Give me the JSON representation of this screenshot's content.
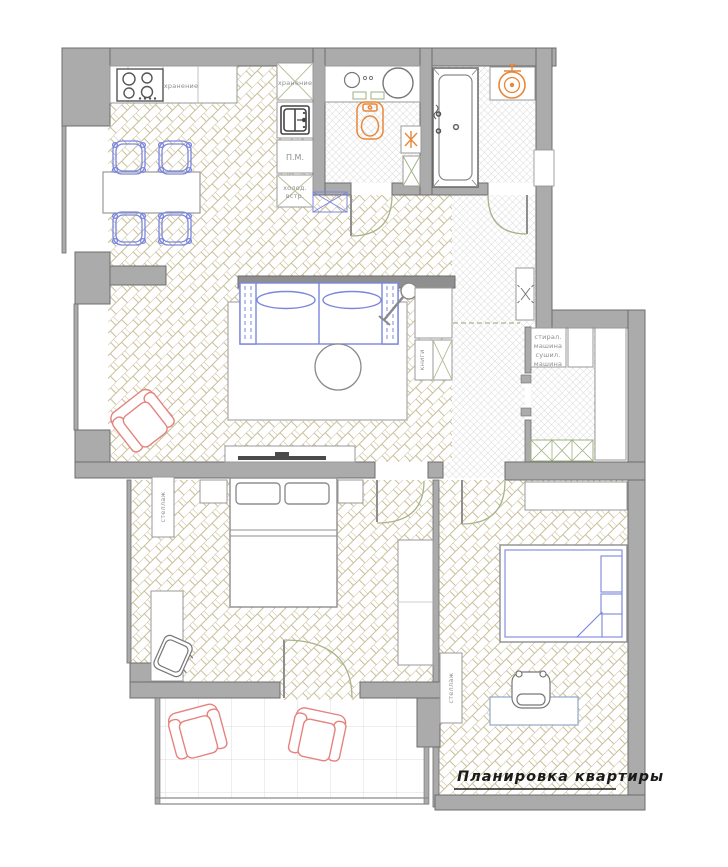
{
  "title": {
    "text": "Планировка квартиры"
  },
  "colors": {
    "wall_fill": "#ababab",
    "wall_outline": "#6e6e6e",
    "wood_hatch": "#c9bf9a",
    "tile_hatch": "#d2d2d2",
    "furniture_blue": "#7b86dd",
    "fixture_orange": "#e8873a",
    "door_green": "#a9b489",
    "armchair_red": "#e5837e",
    "label_gray": "#8f8f8f",
    "title_color": "#1a1a1a"
  },
  "labels": {
    "kitchen_counter_storage": "хранение",
    "kitchen_column_storage": "хранение",
    "dishwasher": "П.М.",
    "fridge": [
      "холод.",
      "встр."
    ],
    "bookshelf": "книги",
    "laundry": [
      "стирал.",
      "машина",
      "сушил.",
      "машина"
    ],
    "bedroom1_shelving": "стеллаж",
    "bedroom2_shelving": "стеллаж"
  }
}
